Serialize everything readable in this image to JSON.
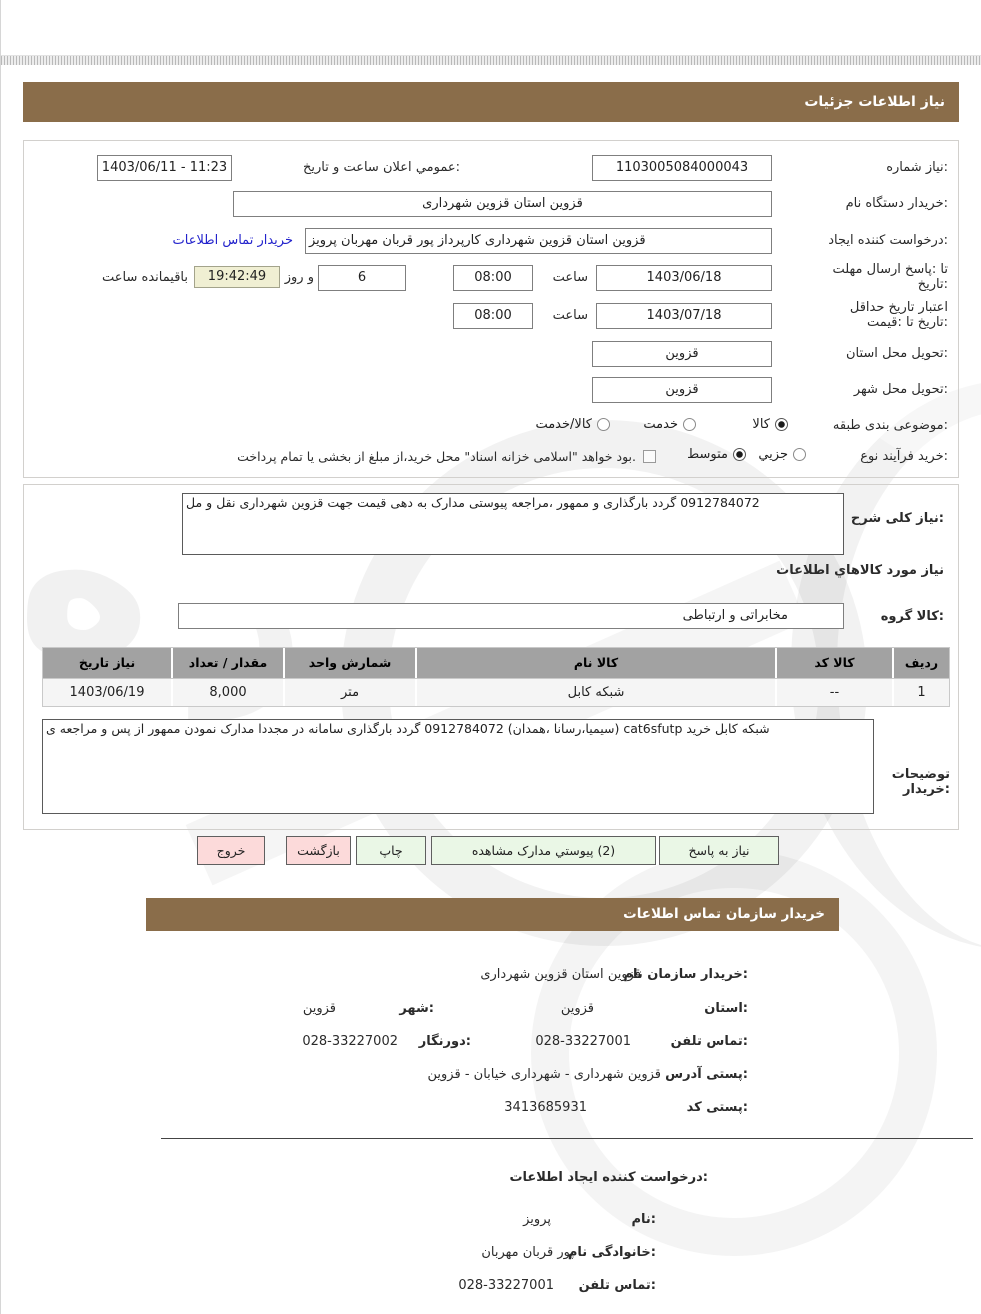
{
  "page": {
    "title_bar1": "جزئیات اطلاعات نیاز",
    "title_bar2": "اطلاعات تماس سازمان خریدار"
  },
  "form": {
    "need_no": {
      "label": "شماره نیاز:",
      "value": "1103005084000043"
    },
    "announce": {
      "label": "تاریخ و ساعت اعلان عمومي:",
      "value": "1403/06/11 - 11:23"
    },
    "buyer_org": {
      "label": "نام دستگاه خریدار:",
      "value": "شهرداری قزوین استان قزوین"
    },
    "creator": {
      "label": "ایجاد کننده درخواست:",
      "value": "پرویز مهربان قربان پور کارپرداز شهرداری قزوین استان قزوین",
      "link": "اطلاعات تماس خریدار"
    },
    "deadline": {
      "label": "مهلت ارسال پاسخ: تا تاریخ:",
      "date": "1403/06/18",
      "time_label": "ساعت",
      "time": "08:00",
      "days": "6",
      "days_label": "روز و",
      "remaining": "19:42:49",
      "remaining_label": "ساعت باقیمانده"
    },
    "validity": {
      "label": "حداقل تاریخ اعتبار قیمت: تا تاریخ:",
      "date": "1403/07/18",
      "time_label": "ساعت",
      "time": "08:00"
    },
    "province": {
      "label": "استان محل تحویل:",
      "value": "قزوین"
    },
    "city": {
      "label": "شهر محل تحویل:",
      "value": "قزوین"
    },
    "category": {
      "label": "طبقه بندی موضوعی:",
      "options": [
        {
          "label": "کالا",
          "checked": true
        },
        {
          "label": "خدمت",
          "checked": false
        },
        {
          "label": "کالا/خدمت",
          "checked": false
        }
      ]
    },
    "process": {
      "label": "نوع فرآیند خرید:",
      "options": [
        {
          "label": "جزیي",
          "checked": false
        },
        {
          "label": "متوسط",
          "checked": true
        }
      ],
      "checkbox_label": "پرداخت تمام یا بخشی از مبلغ خرید،از محل \"اسناد خزانه اسلامی\" خواهد بود.",
      "checkbox_checked": false
    }
  },
  "need": {
    "desc_label": "شرح کلی نیاز:",
    "desc_value": "مل و نقل شهرداری قزوین جهت قیمت دهی به مدارک پیوستی مراجعه، ممهور و بارگذاری گردد 0912784072",
    "items_heading": "اطلاعات کالاهاي مورد نیاز",
    "group_label": "گروه کالا:",
    "group_value": "ارتباطی و مخابراتی",
    "table": {
      "headers": [
        "ردیف",
        "کد کالا",
        "نام کالا",
        "واحد شمارش",
        "تعداد / مقدار",
        "تاریخ نیاز"
      ],
      "rows": [
        [
          "1",
          "--",
          "کابل شبکه",
          "متر",
          "8,000",
          "1403/06/19"
        ]
      ]
    },
    "notes_label": "توضیحات خریدار:",
    "notes_value": "ی مراجعه و پس از ممهور نمودن مدارک مجددا در سامانه بارگذاری گردد 0912784072 (همدان، سیمیا،رسانا) cat6sfutp خرید کابل شبکه"
  },
  "buttons": [
    {
      "label": "پاسخ به نیاز",
      "type": "green"
    },
    {
      "label": "مشاهده مدارک پیوستي (2)",
      "type": "green"
    },
    {
      "label": "چاپ",
      "type": "green"
    },
    {
      "label": "بازگشت",
      "type": "pink"
    },
    {
      "label": "خروج",
      "type": "pink"
    }
  ],
  "contact": {
    "org": {
      "label": "نام سازمان خریدار:",
      "value": "شهرداری قزوین استان قزوین"
    },
    "province": {
      "label": "استان:",
      "value": "قزوین"
    },
    "city": {
      "label": "شهر:",
      "value": "قزوین"
    },
    "phone": {
      "label": "تلفن تماس:",
      "value": "028-33227001"
    },
    "fax": {
      "label": "دورنگار:",
      "value": "028-33227002"
    },
    "address": {
      "label": "آدرس پستی:",
      "value": "قزوین - خیابان شهرداری - شهرداری قزوین"
    },
    "zip": {
      "label": "کد پستی:",
      "value": "3413685931"
    }
  },
  "creator_info": {
    "heading": "اطلاعات ایجاد کننده درخواست:",
    "first_name": {
      "label": "نام:",
      "value": "پرویز"
    },
    "last_name": {
      "label": "نام خانوادگی:",
      "value": "مهربان قربان پور"
    },
    "phone": {
      "label": "تلفن تماس:",
      "value": "028-33227001"
    }
  },
  "colors": {
    "header_brown": "#8a6d4a",
    "button_green": "#eaf7e6",
    "button_pink": "#fcdada",
    "remaining_beige": "#f0efd3"
  }
}
